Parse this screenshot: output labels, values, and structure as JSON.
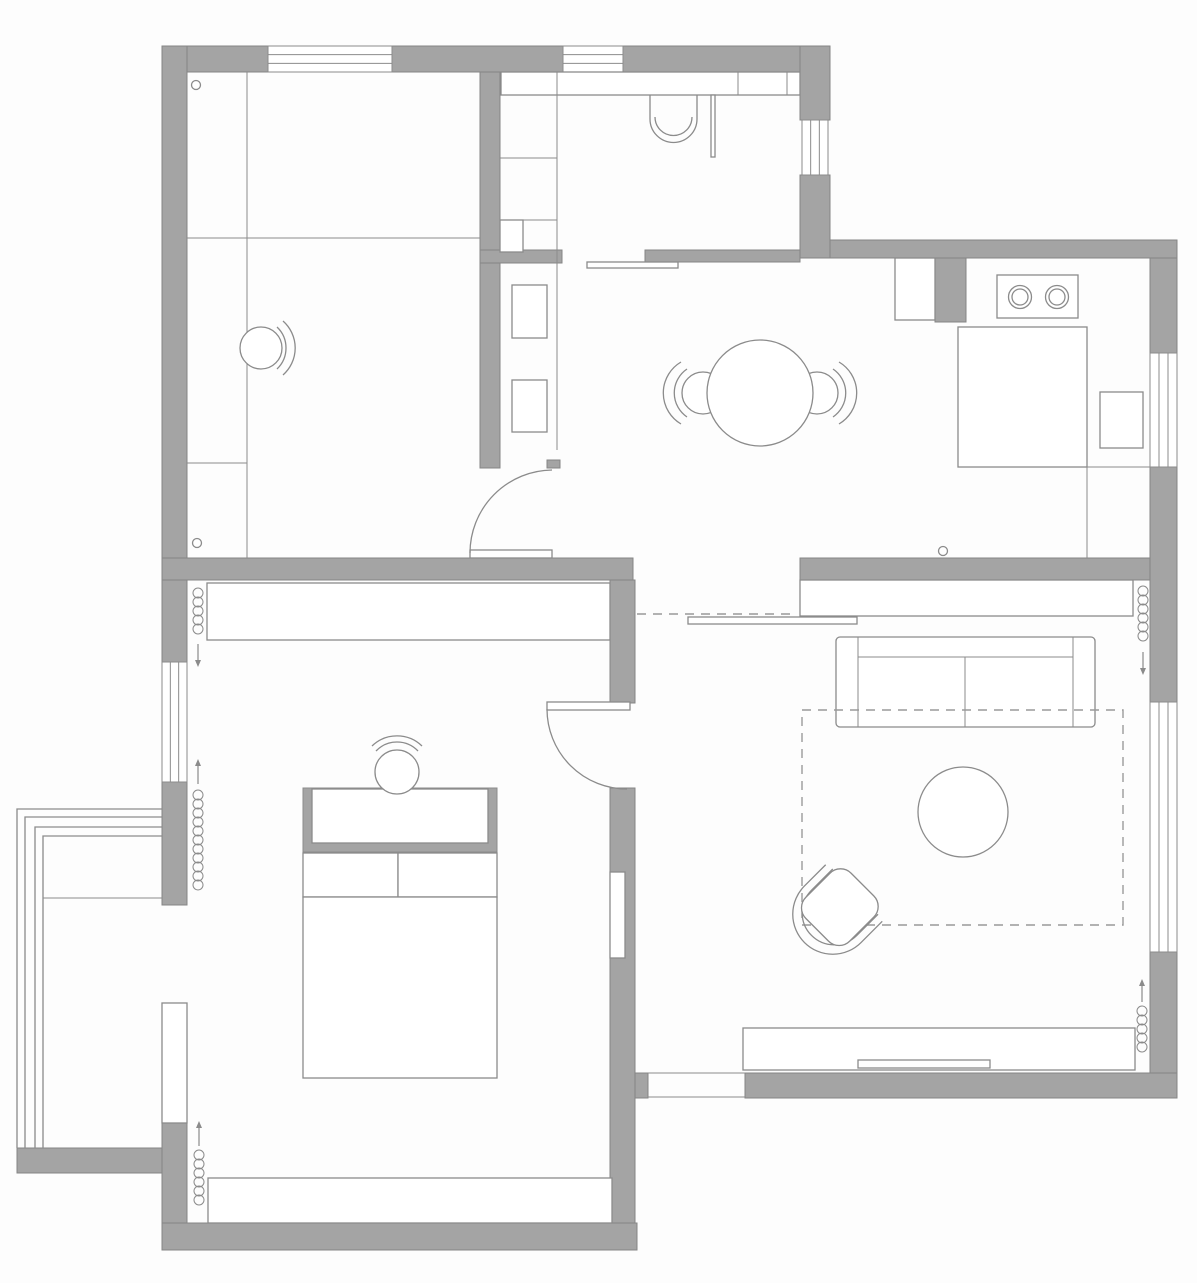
{
  "canvas": {
    "width": 1197,
    "height": 1283,
    "background": "#fdfdfd"
  },
  "colors": {
    "wall_fill": "#a4a4a4",
    "wall_stroke": "#858585",
    "line": "#8b8b8b",
    "fine_line": "#979797",
    "dash": "#9a9a9a",
    "white": "#ffffff"
  },
  "stroke_widths": {
    "wall": 1,
    "furniture": 1.3,
    "fine": 1
  },
  "elements": [
    {
      "type": "wall",
      "name": "top-wall-left",
      "x": 162,
      "y": 46,
      "w": 106,
      "h": 26
    },
    {
      "type": "wall",
      "name": "top-wall-mid",
      "x": 392,
      "y": 46,
      "w": 171,
      "h": 26
    },
    {
      "type": "wall",
      "name": "top-wall-right",
      "x": 623,
      "y": 46,
      "w": 207,
      "h": 26
    },
    {
      "type": "wall",
      "name": "left-wall-upper",
      "x": 162,
      "y": 46,
      "w": 25,
      "h": 512
    },
    {
      "type": "wall",
      "name": "room1-right-wall",
      "x": 480,
      "y": 72,
      "w": 20,
      "h": 396
    },
    {
      "type": "wall",
      "name": "bathroom-right-wall-upper",
      "x": 800,
      "y": 46,
      "w": 30,
      "h": 74
    },
    {
      "type": "wall",
      "name": "bathroom-right-wall-lower",
      "x": 800,
      "y": 175,
      "w": 30,
      "h": 83
    },
    {
      "type": "wall",
      "name": "kitchen-north-wall",
      "x": 830,
      "y": 240,
      "w": 347,
      "h": 18
    },
    {
      "type": "wall",
      "name": "right-wall-kitchen-upper",
      "x": 1150,
      "y": 258,
      "w": 27,
      "h": 95
    },
    {
      "type": "wall",
      "name": "right-wall-kitchen-lower",
      "x": 1150,
      "y": 467,
      "w": 27,
      "h": 235
    },
    {
      "type": "wall",
      "name": "right-wall-living",
      "x": 1150,
      "y": 952,
      "w": 27,
      "h": 146
    },
    {
      "type": "wall",
      "name": "south-band-west",
      "x": 162,
      "y": 558,
      "w": 471,
      "h": 22
    },
    {
      "type": "wall",
      "name": "south-band-east",
      "x": 800,
      "y": 558,
      "w": 350,
      "h": 22
    },
    {
      "type": "wall",
      "name": "bathroom-bottom-wall",
      "x": 645,
      "y": 250,
      "w": 155,
      "h": 12
    },
    {
      "type": "wall",
      "name": "bathroom-shelf-stub",
      "x": 480,
      "y": 250,
      "w": 82,
      "h": 13
    },
    {
      "type": "wall",
      "name": "vestibule-wall-stub",
      "x": 547,
      "y": 460,
      "w": 13,
      "h": 8
    },
    {
      "type": "wall",
      "name": "kitchen-pillar",
      "x": 935,
      "y": 258,
      "w": 31,
      "h": 64
    },
    {
      "type": "wall",
      "name": "bedroom-left-wall-a",
      "x": 162,
      "y": 580,
      "w": 25,
      "h": 82
    },
    {
      "type": "wall",
      "name": "bedroom-left-wall-b",
      "x": 162,
      "y": 782,
      "w": 25,
      "h": 123
    },
    {
      "type": "wall",
      "name": "bedroom-left-wall-c",
      "x": 162,
      "y": 1123,
      "w": 25,
      "h": 100
    },
    {
      "type": "wall",
      "name": "bedroom-bottom-wall",
      "x": 162,
      "y": 1223,
      "w": 475,
      "h": 27
    },
    {
      "type": "wall",
      "name": "bedroom-right-wall-a",
      "x": 610,
      "y": 580,
      "w": 25,
      "h": 123
    },
    {
      "type": "wall",
      "name": "bedroom-right-wall-b",
      "x": 610,
      "y": 788,
      "w": 25,
      "h": 435
    },
    {
      "type": "wall",
      "name": "bedroom-right-wall-stub",
      "x": 635,
      "y": 1073,
      "w": 13,
      "h": 25
    },
    {
      "type": "wall",
      "name": "living-bottom-wall",
      "x": 745,
      "y": 1073,
      "w": 432,
      "h": 25
    },
    {
      "type": "wall",
      "name": "balcony-bottom-band",
      "x": 17,
      "y": 1148,
      "w": 145,
      "h": 25
    },
    {
      "type": "window",
      "name": "window-top-1",
      "x": 268,
      "y": 46,
      "w": 124,
      "h": 26,
      "orient": "h"
    },
    {
      "type": "window",
      "name": "window-top-2",
      "x": 563,
      "y": 46,
      "w": 60,
      "h": 26,
      "orient": "h"
    },
    {
      "type": "window",
      "name": "window-bathroom",
      "x": 802,
      "y": 120,
      "w": 26,
      "h": 55,
      "orient": "v"
    },
    {
      "type": "window",
      "name": "window-kitchen",
      "x": 1150,
      "y": 353,
      "w": 27,
      "h": 114,
      "orient": "v"
    },
    {
      "type": "window",
      "name": "window-living",
      "x": 1150,
      "y": 702,
      "w": 27,
      "h": 250,
      "orient": "v"
    },
    {
      "type": "window",
      "name": "window-bedroom",
      "x": 162,
      "y": 662,
      "w": 25,
      "h": 120,
      "orient": "v"
    },
    {
      "type": "wrect",
      "name": "balcony-door-panel",
      "x": 162,
      "y": 1003,
      "w": 25,
      "h": 120
    },
    {
      "type": "wrect",
      "name": "wall-niche",
      "x": 610,
      "y": 872,
      "w": 15,
      "h": 86
    },
    {
      "type": "line",
      "name": "room1-divider-vertical",
      "x1": 247,
      "y1": 72,
      "x2": 247,
      "y2": 558
    },
    {
      "type": "line",
      "name": "room1-divider-horizontal",
      "x1": 187,
      "y1": 238,
      "x2": 480,
      "y2": 238
    },
    {
      "type": "line",
      "name": "room1-desk-divider",
      "x1": 187,
      "y1": 463,
      "x2": 247,
      "y2": 463
    },
    {
      "type": "wrect",
      "name": "bathroom-top-cabinet",
      "x": 501,
      "y": 72,
      "w": 299,
      "h": 23
    },
    {
      "type": "line",
      "name": "bath-cabinet-divider-1",
      "x1": 557,
      "y1": 72,
      "x2": 557,
      "y2": 95
    },
    {
      "type": "line",
      "name": "bath-cabinet-divider-2",
      "x1": 738,
      "y1": 72,
      "x2": 738,
      "y2": 95
    },
    {
      "type": "line",
      "name": "bath-cabinet-divider-3",
      "x1": 787,
      "y1": 72,
      "x2": 787,
      "y2": 95
    },
    {
      "type": "line",
      "name": "vestibule-strip-line",
      "x1": 557,
      "y1": 95,
      "x2": 557,
      "y2": 450
    },
    {
      "type": "line",
      "name": "vanity-divider-1",
      "x1": 500,
      "y1": 158,
      "x2": 557,
      "y2": 158
    },
    {
      "type": "line",
      "name": "vanity-divider-2",
      "x1": 500,
      "y1": 220,
      "x2": 557,
      "y2": 220
    },
    {
      "type": "wrect",
      "name": "vanity-step",
      "x": 500,
      "y": 220,
      "w": 23,
      "h": 32
    },
    {
      "type": "wrect",
      "name": "hall-drawer-1",
      "x": 512,
      "y": 285,
      "w": 35,
      "h": 53
    },
    {
      "type": "wrect",
      "name": "hall-drawer-2",
      "x": 512,
      "y": 380,
      "w": 35,
      "h": 52
    },
    {
      "type": "path",
      "name": "toilet-bowl",
      "d": "M 650 95 V 119 A 23.5 23.5 0 0 0 697 119 V 95"
    },
    {
      "type": "path",
      "name": "toilet-seat-arc",
      "d": "M 655 117 A 18.5 18.5 0 0 0 692 117"
    },
    {
      "type": "wrect",
      "name": "shower-glass-panel",
      "x": 711,
      "y": 95,
      "w": 4,
      "h": 62
    },
    {
      "type": "wrect",
      "name": "bathroom-sliding-door",
      "x": 587,
      "y": 262,
      "w": 91,
      "h": 6
    },
    {
      "type": "wrect",
      "name": "kitchen-counter-small",
      "x": 895,
      "y": 258,
      "w": 40,
      "h": 62
    },
    {
      "type": "wrect",
      "name": "stove",
      "x": 997,
      "y": 275,
      "w": 81,
      "h": 43
    },
    {
      "type": "circle",
      "name": "burner-left",
      "cx": 1020,
      "cy": 297,
      "r": 11.5
    },
    {
      "type": "circle",
      "name": "burner-left-inner",
      "cx": 1020,
      "cy": 297,
      "r": 8
    },
    {
      "type": "circle",
      "name": "burner-right",
      "cx": 1057,
      "cy": 297,
      "r": 11.5
    },
    {
      "type": "circle",
      "name": "burner-right-inner",
      "cx": 1057,
      "cy": 297,
      "r": 8
    },
    {
      "type": "wrect",
      "name": "kitchen-counter-big",
      "x": 958,
      "y": 327,
      "w": 129,
      "h": 140
    },
    {
      "type": "wrect",
      "name": "kitchen-appliance",
      "x": 1100,
      "y": 392,
      "w": 43,
      "h": 56
    },
    {
      "type": "line",
      "name": "kitchen-edge-vertical",
      "x1": 1087,
      "y1": 467,
      "x2": 1087,
      "y2": 558
    },
    {
      "type": "line",
      "name": "kitchen-edge-horizontal",
      "x1": 1087,
      "y1": 467,
      "x2": 1150,
      "y2": 467
    },
    {
      "type": "circle",
      "name": "dining-chair-left-seat",
      "cx": 703,
      "cy": 393,
      "r": 21
    },
    {
      "type": "path",
      "name": "dining-chair-left-back-inner",
      "d": "M 687 369 A 29 29 0 0 0 687 417"
    },
    {
      "type": "path",
      "name": "dining-chair-left-back-outer",
      "d": "M 681 362 A 36 36 0 0 0 681 424"
    },
    {
      "type": "circle",
      "name": "dining-chair-right-seat",
      "cx": 817,
      "cy": 393,
      "r": 21
    },
    {
      "type": "path",
      "name": "dining-chair-right-back-inner",
      "d": "M 833 369 A 29 29 0 0 1 833 417"
    },
    {
      "type": "path",
      "name": "dining-chair-right-back-outer",
      "d": "M 839 362 A 36 36 0 0 1 839 424"
    },
    {
      "type": "circle",
      "name": "dining-table",
      "cx": 760,
      "cy": 393,
      "r": 53
    },
    {
      "type": "circle",
      "name": "room1-chair-seat",
      "cx": 261,
      "cy": 348,
      "r": 21
    },
    {
      "type": "path",
      "name": "room1-chair-back-inner",
      "d": "M 277 327 A 29 29 0 0 1 277 369"
    },
    {
      "type": "path",
      "name": "room1-chair-back-outer",
      "d": "M 283 321 A 36 36 0 0 1 283 375"
    },
    {
      "type": "circle",
      "name": "door-stop-room1",
      "cx": 196,
      "cy": 85,
      "r": 4.5
    },
    {
      "type": "circle",
      "name": "door-stop-room1-south",
      "cx": 197,
      "cy": 543,
      "r": 4.5
    },
    {
      "type": "circle",
      "name": "door-stop-kitchen",
      "cx": 943,
      "cy": 551,
      "r": 4.5
    },
    {
      "type": "dline",
      "name": "overhead-cabinet-dashed",
      "x1": 637,
      "y1": 614,
      "x2": 797,
      "y2": 614
    },
    {
      "type": "wrect",
      "name": "living-north-cabinet",
      "x": 800,
      "y": 580,
      "w": 333,
      "h": 36
    },
    {
      "type": "wrect",
      "name": "living-sliding-door",
      "x": 688,
      "y": 617,
      "w": 169,
      "h": 7
    },
    {
      "type": "wrect",
      "name": "sofa-body",
      "x": 836,
      "y": 637,
      "w": 259,
      "h": 90,
      "rx": 4
    },
    {
      "type": "line",
      "name": "sofa-arm-left",
      "x1": 858,
      "y1": 637,
      "x2": 858,
      "y2": 727
    },
    {
      "type": "line",
      "name": "sofa-arm-right",
      "x1": 1073,
      "y1": 637,
      "x2": 1073,
      "y2": 727
    },
    {
      "type": "line",
      "name": "sofa-back",
      "x1": 858,
      "y1": 657,
      "x2": 1073,
      "y2": 657
    },
    {
      "type": "line",
      "name": "sofa-seat-divider",
      "x1": 965,
      "y1": 657,
      "x2": 965,
      "y2": 727
    },
    {
      "type": "drect",
      "name": "rug-dashed",
      "x": 802,
      "y": 710,
      "w": 321,
      "h": 215
    },
    {
      "type": "circle",
      "name": "coffee-table",
      "cx": 963,
      "cy": 812,
      "r": 45
    },
    {
      "type": "path",
      "name": "armchair-back-outer",
      "d": "M 797 886 V 916 A 40 40 0 0 0 877 916 V 886",
      "tf": "rotate(45 837 910)"
    },
    {
      "type": "path",
      "name": "armchair-back-inner",
      "d": "M 805 884 V 914 A 32 32 0 0 0 869 914 V 884",
      "tf": "rotate(45 837 910)"
    },
    {
      "type": "wrect",
      "name": "armchair-seat",
      "x": 806,
      "y": 874,
      "w": 62,
      "h": 64,
      "rx": 15,
      "tf": "rotate(45 837 910)"
    },
    {
      "type": "wrect",
      "name": "tv-console",
      "x": 743,
      "y": 1028,
      "w": 392,
      "h": 42
    },
    {
      "type": "wrect",
      "name": "tv-unit",
      "x": 858,
      "y": 1060,
      "w": 132,
      "h": 8
    },
    {
      "type": "line",
      "name": "entry-threshold-top",
      "x1": 648,
      "y1": 1073,
      "x2": 745,
      "y2": 1073
    },
    {
      "type": "line",
      "name": "entry-threshold-bottom",
      "x1": 648,
      "y1": 1097,
      "x2": 745,
      "y2": 1097
    },
    {
      "type": "wrect",
      "name": "bedroom-wardrobe",
      "x": 207,
      "y": 583,
      "w": 403,
      "h": 57
    },
    {
      "type": "wrect",
      "name": "bedroom-window-seat",
      "x": 208,
      "y": 1178,
      "w": 404,
      "h": 45
    },
    {
      "type": "grect",
      "name": "vanity-screen",
      "x": 303,
      "y": 788,
      "w": 194,
      "h": 64
    },
    {
      "type": "wrect",
      "name": "vanity-desktop",
      "x": 312,
      "y": 789,
      "w": 176,
      "h": 54
    },
    {
      "type": "circle",
      "name": "vanity-stool",
      "cx": 397,
      "cy": 772,
      "r": 22
    },
    {
      "type": "path",
      "name": "vanity-stool-back-inner",
      "d": "M 376 751 A 29 29 0 0 1 418 751"
    },
    {
      "type": "path",
      "name": "vanity-stool-back-outer",
      "d": "M 372 746 A 36 36 0 0 1 422 746"
    },
    {
      "type": "wrect",
      "name": "pillow-left",
      "x": 303,
      "y": 853,
      "w": 95,
      "h": 44
    },
    {
      "type": "wrect",
      "name": "pillow-right",
      "x": 398,
      "y": 853,
      "w": 99,
      "h": 44
    },
    {
      "type": "wrect",
      "name": "bed",
      "x": 303,
      "y": 897,
      "w": 194,
      "h": 181
    },
    {
      "type": "path",
      "name": "balcony-rail-1",
      "d": "M 17 1148 V 809 H 162"
    },
    {
      "type": "path",
      "name": "balcony-rail-2",
      "d": "M 25 1148 V 817 H 162"
    },
    {
      "type": "path",
      "name": "balcony-rail-3",
      "d": "M 35 1148 V 827 H 162"
    },
    {
      "type": "path",
      "name": "balcony-rail-4",
      "d": "M 43 1148 V 836 H 162"
    },
    {
      "type": "line",
      "name": "balcony-floor-line",
      "x1": 43,
      "y1": 898,
      "x2": 162,
      "y2": 898
    },
    {
      "type": "wrect",
      "name": "room1-door-leaf",
      "x": 470,
      "y": 550,
      "w": 82,
      "h": 8
    },
    {
      "type": "path",
      "name": "room1-door-swing",
      "d": "M 470 553 A 83 83 0 0 1 552 470"
    },
    {
      "type": "wrect",
      "name": "bedroom-door-leaf",
      "x": 547,
      "y": 702,
      "w": 83,
      "h": 8
    },
    {
      "type": "path",
      "name": "bedroom-door-swing",
      "d": "M 547 709 A 80 80 0 0 0 627 789"
    },
    {
      "type": "coil",
      "name": "radiator-bedroom-upper",
      "x": 198,
      "y1": 588,
      "y2": 638,
      "r": 5,
      "step": 9
    },
    {
      "type": "arrow",
      "name": "radiator-arrow-bedroom-upper",
      "x": 198,
      "y1": 644,
      "y2": 660,
      "tip": "end"
    },
    {
      "type": "coil",
      "name": "radiator-bedroom-mid",
      "x": 198,
      "y1": 790,
      "y2": 896,
      "r": 5,
      "step": 9
    },
    {
      "type": "arrow",
      "name": "radiator-arrow-bedroom-mid",
      "x": 198,
      "y1": 766,
      "y2": 784,
      "tip": "start"
    },
    {
      "type": "coil",
      "name": "radiator-bedroom-lower",
      "x": 199,
      "y1": 1150,
      "y2": 1210,
      "r": 5,
      "step": 9
    },
    {
      "type": "arrow",
      "name": "radiator-arrow-bedroom-lower",
      "x": 199,
      "y1": 1128,
      "y2": 1146,
      "tip": "start"
    },
    {
      "type": "coil",
      "name": "radiator-living-upper",
      "x": 1143,
      "y1": 586,
      "y2": 646,
      "r": 5,
      "step": 9
    },
    {
      "type": "arrow",
      "name": "radiator-arrow-living-upper",
      "x": 1143,
      "y1": 652,
      "y2": 668,
      "tip": "end"
    },
    {
      "type": "coil",
      "name": "radiator-living-lower",
      "x": 1142,
      "y1": 1006,
      "y2": 1058,
      "r": 5,
      "step": 9
    },
    {
      "type": "arrow",
      "name": "radiator-arrow-living-lower",
      "x": 1142,
      "y1": 986,
      "y2": 1002,
      "tip": "start"
    }
  ]
}
